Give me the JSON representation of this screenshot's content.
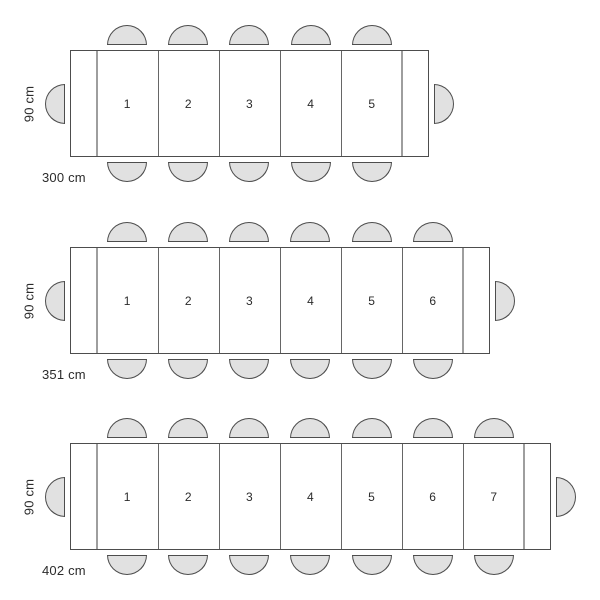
{
  "colors": {
    "table_outline": "#4d4d4d",
    "segment_divider": "#666666",
    "leaf_divider": "#9e9e9e",
    "chair_fill": "#e1e1e1",
    "chair_stroke": "#4d4d4d",
    "label_text": "#2b2b2b",
    "page_background": "#ffffff"
  },
  "diagrams": [
    {
      "id": "table-300cm",
      "length_cm": 300,
      "depth_cm": 90,
      "length_label": "300 cm",
      "depth_label": "90 cm",
      "side_seats_per_side": 5,
      "head_seats": 2,
      "seat_numbers": [
        "1",
        "2",
        "3",
        "4",
        "5"
      ]
    },
    {
      "id": "table-351cm",
      "length_cm": 351,
      "depth_cm": 90,
      "length_label": "351 cm",
      "depth_label": "90 cm",
      "side_seats_per_side": 6,
      "head_seats": 2,
      "seat_numbers": [
        "1",
        "2",
        "3",
        "4",
        "5",
        "6"
      ]
    },
    {
      "id": "table-402cm",
      "length_cm": 402,
      "depth_cm": 90,
      "length_label": "402 cm",
      "depth_label": "90 cm",
      "side_seats_per_side": 7,
      "head_seats": 2,
      "seat_numbers": [
        "1",
        "2",
        "3",
        "4",
        "5",
        "6",
        "7"
      ]
    }
  ]
}
